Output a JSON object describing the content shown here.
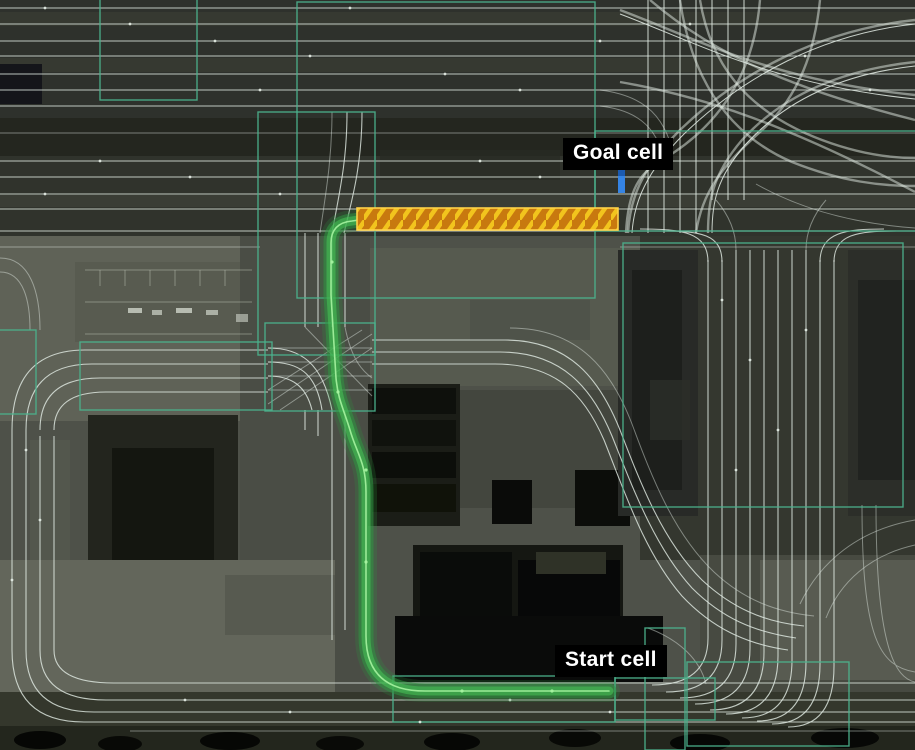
{
  "map": {
    "description": "Aerial grayscale lane-graph map with a planned route between two annotated cells",
    "labels": {
      "goal": "Goal cell",
      "start": "Start cell"
    },
    "icons": {
      "goal_marker": "goal-position-marker",
      "goal_highlight": "goal-cell-hatched-highlight",
      "route": "planned-route-path"
    }
  },
  "colors": {
    "route_green": "#2f9641",
    "route_green_mid": "#46c055",
    "route_green_bright": "#a5f3a0",
    "goal_fill": "#c8790f",
    "goal_stripe": "#f2c41d",
    "goal_border": "#ffd24a",
    "marker_blue": "#3584e4",
    "cell_teal": "#4bb38d",
    "lane_line": "#e4ede6",
    "label_bg": "#000000",
    "label_fg": "#ffffff"
  }
}
